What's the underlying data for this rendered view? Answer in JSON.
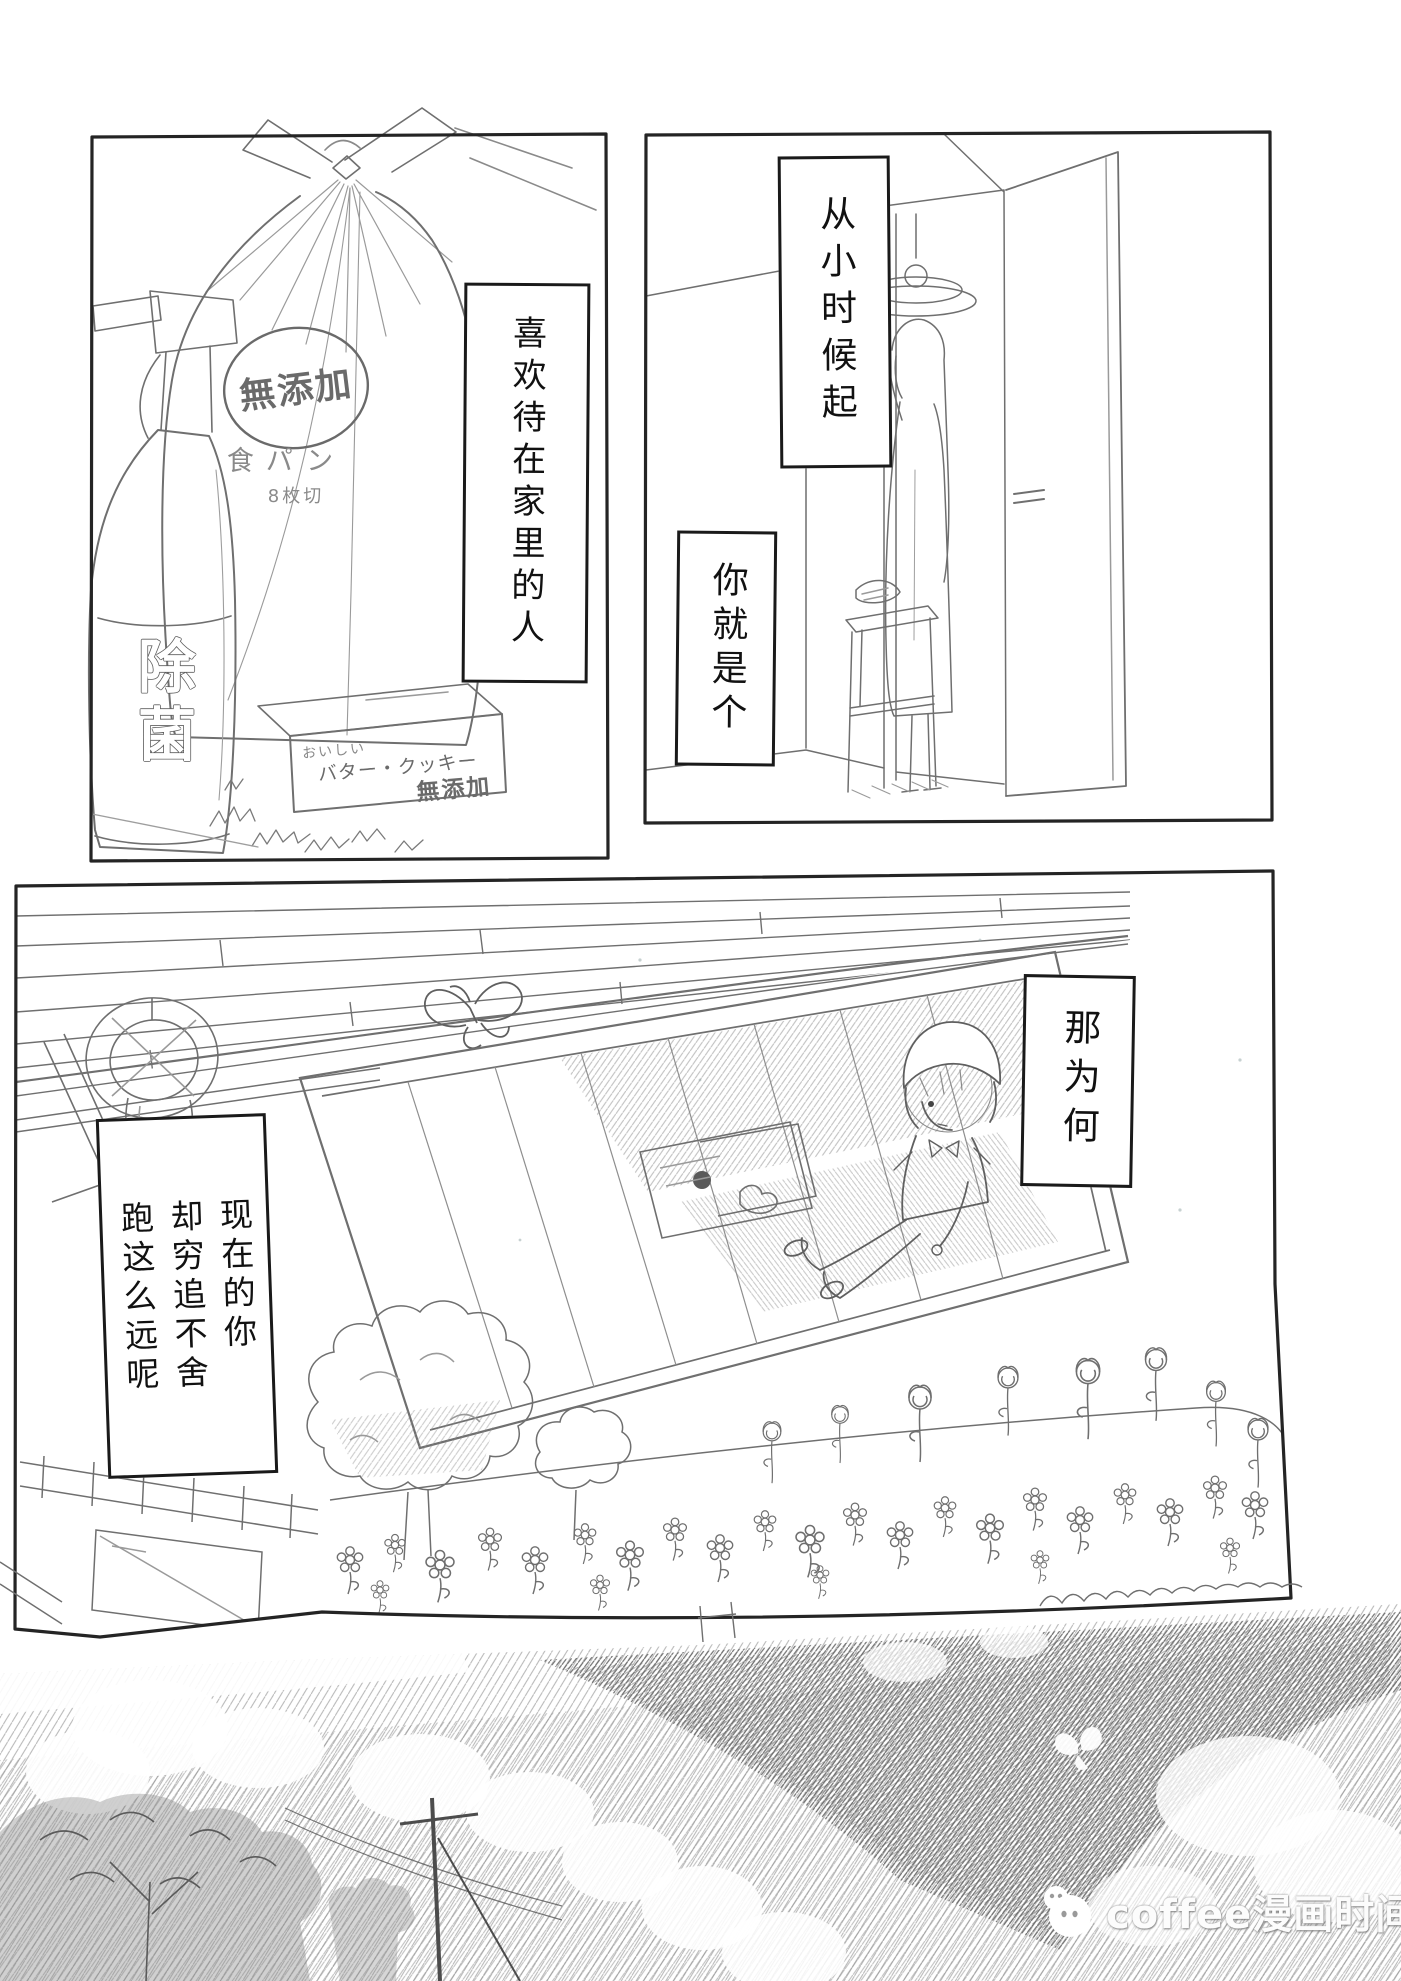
{
  "panels": {
    "top_left": {
      "speech": "喜欢待在家里的人",
      "bread_bag": {
        "badge": "無添加",
        "name": "食パン",
        "slices": "8枚切"
      },
      "spray_bottle": {
        "label": "除菌"
      },
      "cookie_box": {
        "line1": "おいしい",
        "line2": "バター・クッキー",
        "line3": "無添加"
      }
    },
    "top_right": {
      "speech_1": "从小时候起",
      "speech_2": "你就是个"
    },
    "middle": {
      "speech_1": "那为何",
      "speech_2": "现在的你\n却穷追不舍\n跑这么远呢"
    }
  },
  "watermark": {
    "text": "coffee漫画时间",
    "logo": "chat-faces-icon"
  },
  "colors": {
    "paper": "#ffffff",
    "panel_ink": "#242424",
    "line": "#6f6f6f",
    "pencil": "#949494",
    "text": "#111111",
    "watermark_text": "#fcfcfc"
  }
}
